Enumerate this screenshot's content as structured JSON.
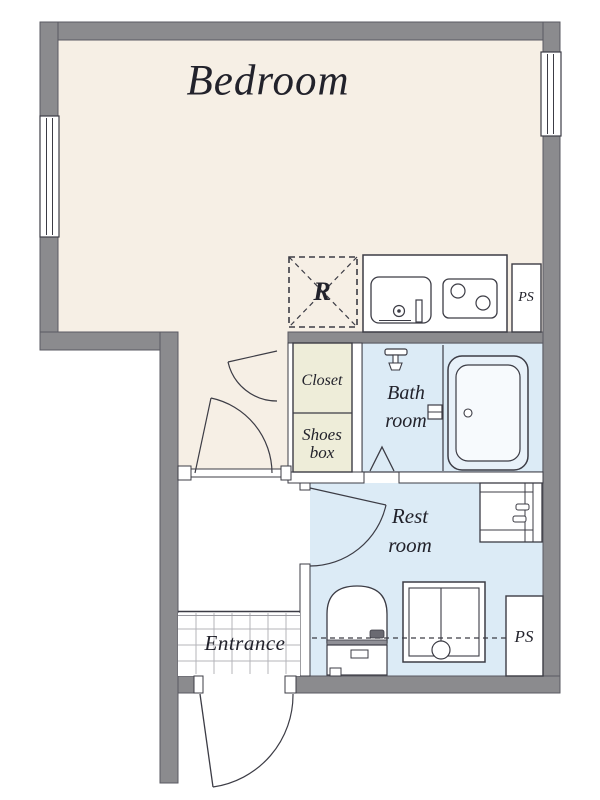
{
  "rooms": {
    "bedroom": {
      "label": "Bedroom"
    },
    "closet": {
      "label": "Closet"
    },
    "shoes_box": {
      "label": "Shoes\nbox"
    },
    "bath_room": {
      "label": "Bath\nroom"
    },
    "rest_room": {
      "label": "Rest\nroom"
    },
    "entrance": {
      "label": "Entrance"
    }
  },
  "spaces": {
    "refrigerator": {
      "label": "R"
    },
    "pipe_space_top": {
      "label": "PS"
    },
    "pipe_space_bottom": {
      "label": "PS"
    }
  },
  "fixtures": [
    "kitchen-counter",
    "kitchen-sink",
    "gas-stove-2-burner",
    "refrigerator-space",
    "closet-double-door",
    "bedroom-door",
    "bathtub",
    "shower-head",
    "bath-folding-door",
    "washbasin-vanity",
    "toilet",
    "washing-machine-pan",
    "restroom-door",
    "entrance-door",
    "window-left",
    "window-right",
    "entrance-tile-floor"
  ],
  "colors": {
    "walls": "#8b8b8e",
    "wall_edge": "#5a5a62",
    "line": "#3c3c45",
    "bedroom_floor": "#f6efe5",
    "closet_fill": "#eeedd9",
    "wet_room_fill": "#dcebf6",
    "tub_fill": "#e8f1f9",
    "tile_line": "#b4b4ba",
    "text": "#22222b"
  }
}
